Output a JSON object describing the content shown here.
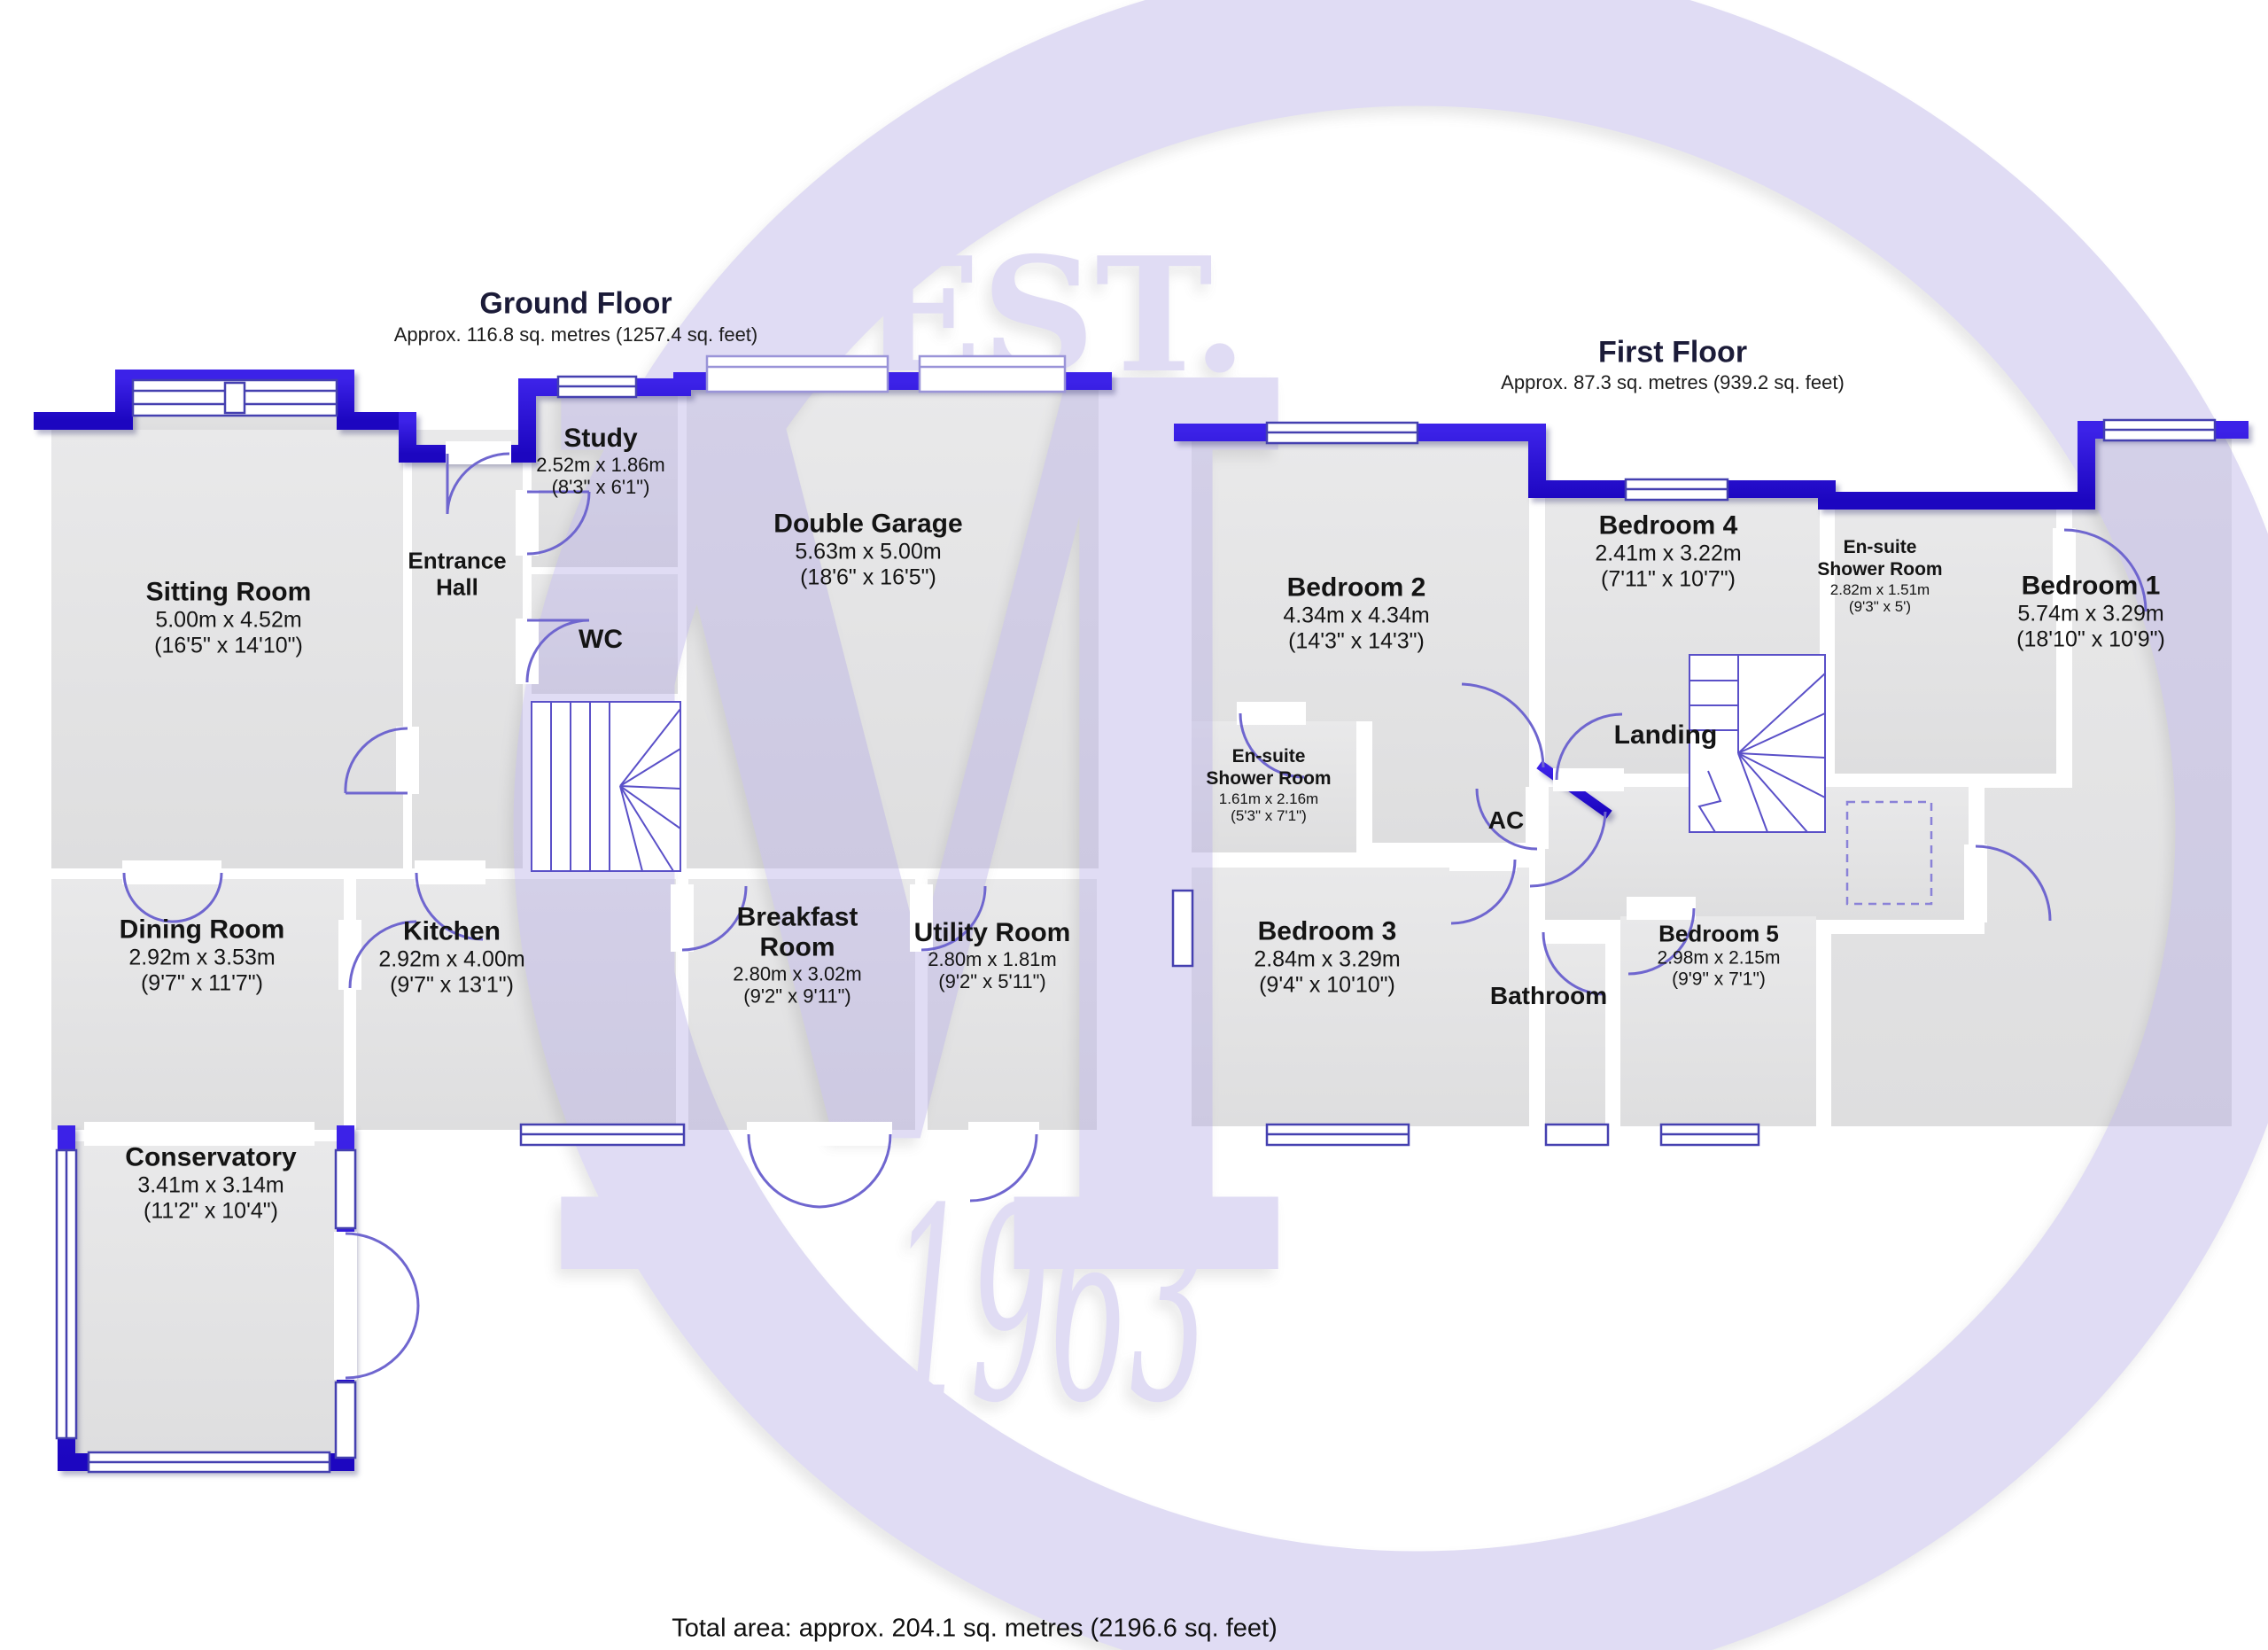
{
  "watermark": {
    "line1": "EST.",
    "letter": "M",
    "year": "1963",
    "color": "#b7aee6"
  },
  "colors": {
    "wall": "#2c10d4",
    "floor": "#e4e4e6",
    "door_arc": "#6f66cf",
    "window_frame": "#4540b0"
  },
  "footer": {
    "total_area": "Total area: approx. 204.1 sq. metres (2196.6 sq. feet)"
  },
  "ground_floor": {
    "title": "Ground Floor",
    "subtitle": "Approx. 116.8 sq. metres (1257.4 sq. feet)",
    "rooms": {
      "sitting": {
        "name": "Sitting Room",
        "dims_m": "5.00m x 4.52m",
        "dims_ft": "(16'5\" x 14'10\")"
      },
      "entrance": {
        "name": "Entrance Hall"
      },
      "study": {
        "name": "Study",
        "dims_m": "2.52m x 1.86m",
        "dims_ft": "(8'3\" x 6'1\")"
      },
      "wc": {
        "name": "WC"
      },
      "garage": {
        "name": "Double Garage",
        "dims_m": "5.63m x 5.00m",
        "dims_ft": "(18'6\" x 16'5\")"
      },
      "dining": {
        "name": "Dining Room",
        "dims_m": "2.92m x 3.53m",
        "dims_ft": "(9'7\" x 11'7\")"
      },
      "kitchen": {
        "name": "Kitchen",
        "dims_m": "2.92m x 4.00m",
        "dims_ft": "(9'7\" x 13'1\")"
      },
      "breakfast": {
        "name": "Breakfast Room",
        "dims_m": "2.80m x 3.02m",
        "dims_ft": "(9'2\" x 9'11\")"
      },
      "utility": {
        "name": "Utility Room",
        "dims_m": "2.80m x 1.81m",
        "dims_ft": "(9'2\" x 5'11\")"
      },
      "conservatory": {
        "name": "Conservatory",
        "dims_m": "3.41m x 3.14m",
        "dims_ft": "(11'2\" x 10'4\")"
      }
    }
  },
  "first_floor": {
    "title": "First Floor",
    "subtitle": "Approx. 87.3 sq. metres (939.2 sq. feet)",
    "rooms": {
      "bedroom2": {
        "name": "Bedroom 2",
        "dims_m": "4.34m x 4.34m",
        "dims_ft": "(14'3\" x 14'3\")"
      },
      "bedroom4": {
        "name": "Bedroom 4",
        "dims_m": "2.41m x 3.22m",
        "dims_ft": "(7'11\" x 10'7\")"
      },
      "ensuite1": {
        "name": "En-suite Shower Room",
        "dims_m": "2.82m x 1.51m",
        "dims_ft": "(9'3\" x 5')"
      },
      "bedroom1": {
        "name": "Bedroom 1",
        "dims_m": "5.74m x 3.29m",
        "dims_ft": "(18'10\" x 10'9\")"
      },
      "ensuite2": {
        "name": "En-suite Shower Room",
        "dims_m": "1.61m x 2.16m",
        "dims_ft": "(5'3\" x 7'1\")"
      },
      "landing": {
        "name": "Landing"
      },
      "ac": {
        "name": "AC"
      },
      "bedroom3": {
        "name": "Bedroom 3",
        "dims_m": "2.84m x 3.29m",
        "dims_ft": "(9'4\" x 10'10\")"
      },
      "bathroom": {
        "name": "Bathroom"
      },
      "bedroom5": {
        "name": "Bedroom 5",
        "dims_m": "2.98m x 2.15m",
        "dims_ft": "(9'9\" x 7'1\")"
      }
    }
  }
}
